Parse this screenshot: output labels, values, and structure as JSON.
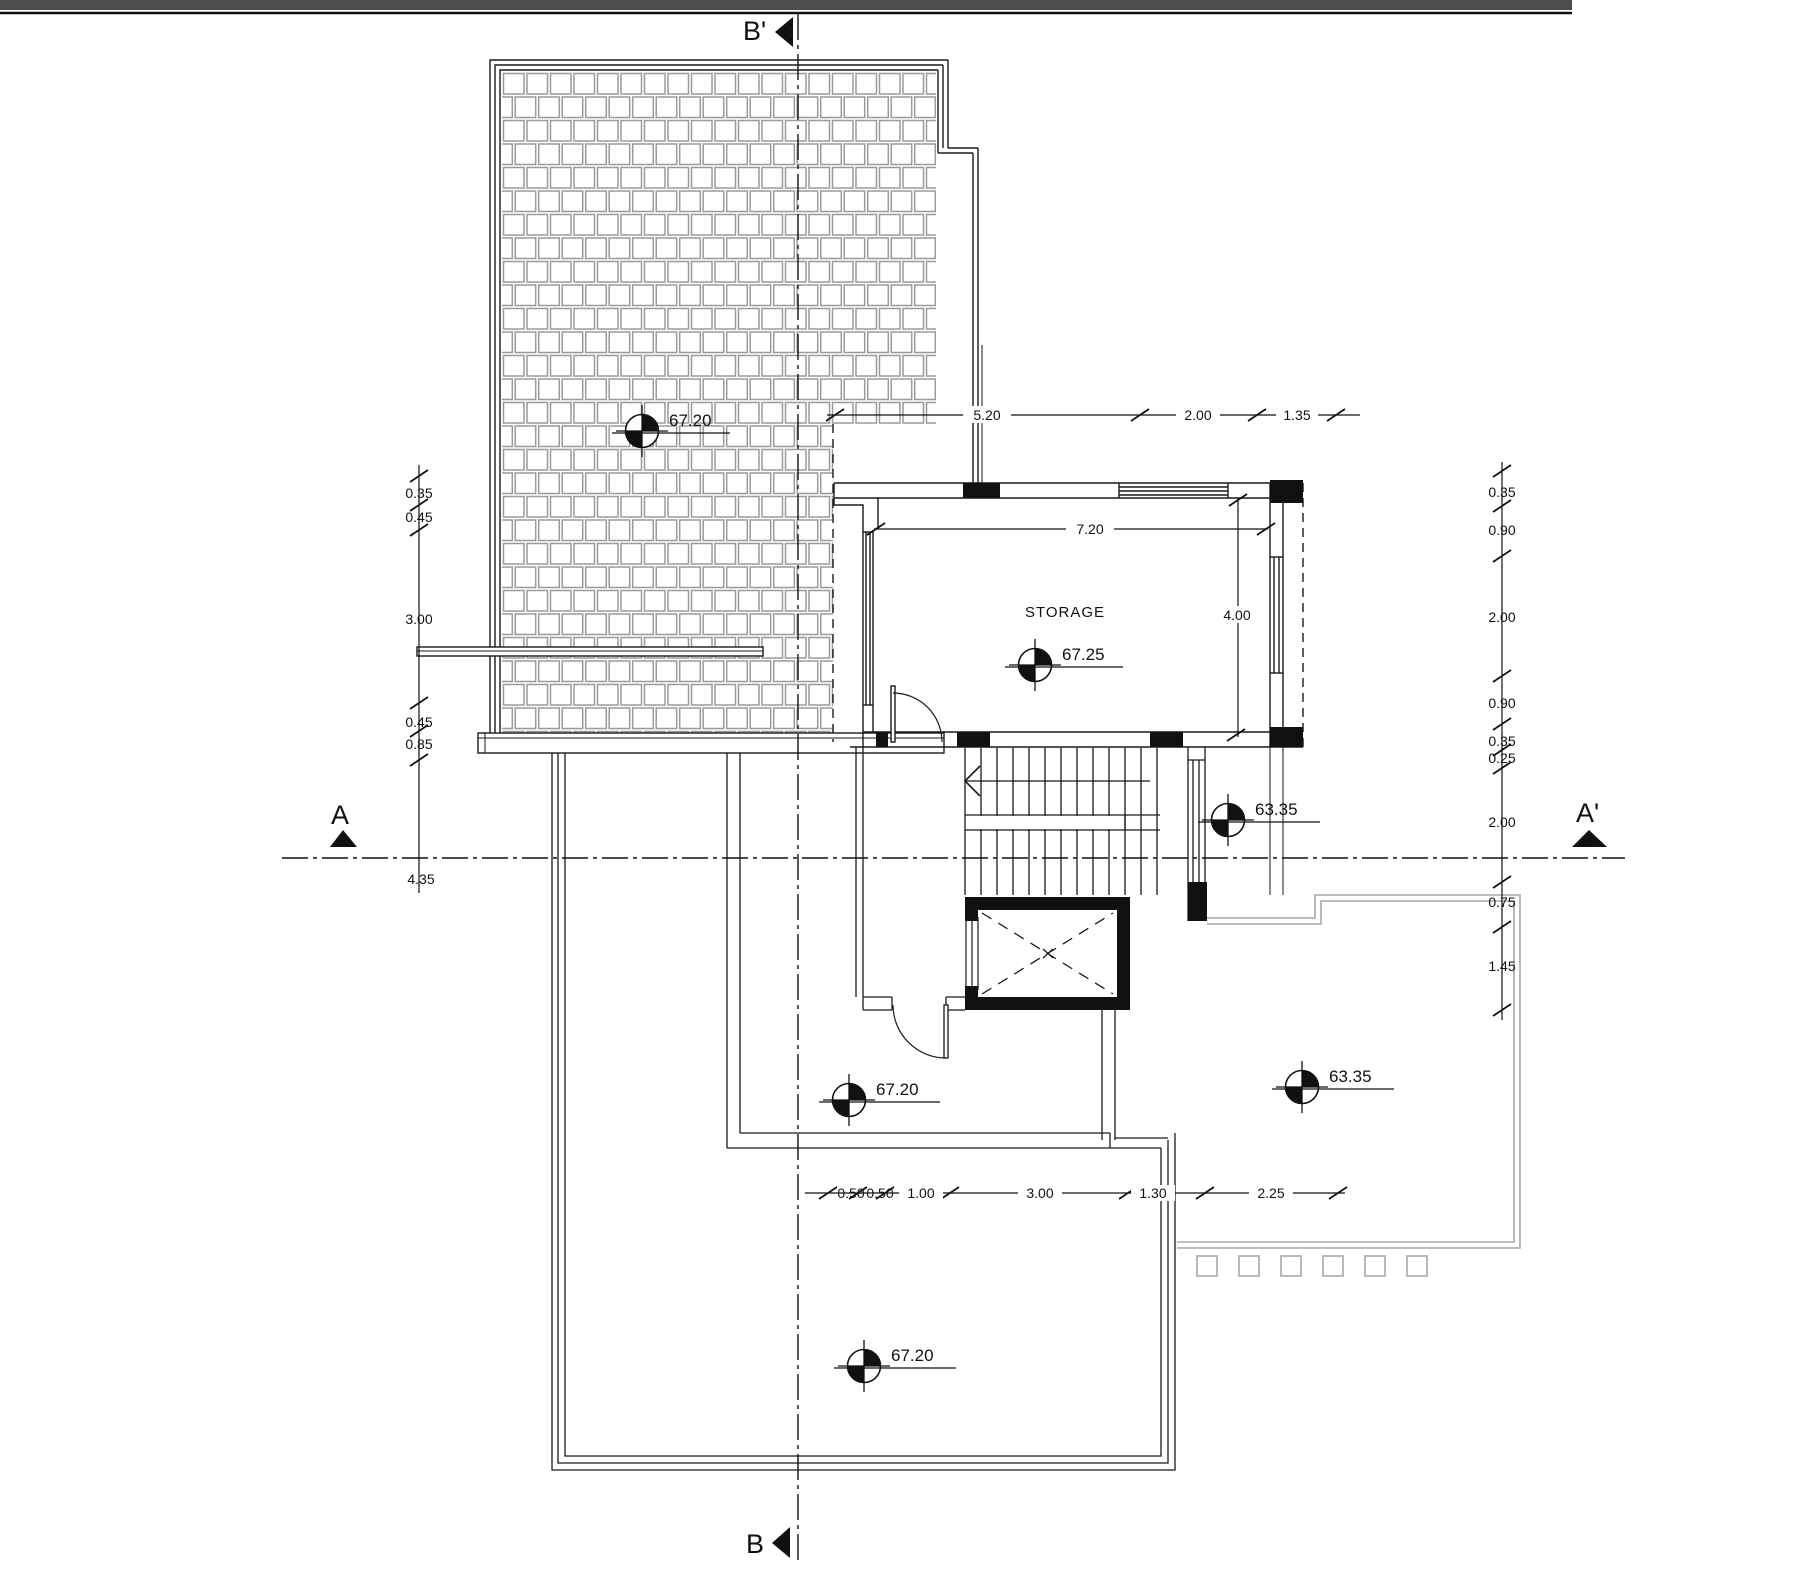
{
  "drawing_type": "architectural-roof-plan",
  "sections": {
    "b_prime": "B'",
    "b": "B",
    "a": "A",
    "a_prime": "A'"
  },
  "rooms": {
    "storage": "STORAGE"
  },
  "levels": {
    "roof": "67.20",
    "storage": "67.25",
    "stair_landing": "63.35",
    "mid_terrace": "67.20",
    "balcony": "63.35",
    "lower_terrace": "67.20"
  },
  "dims": {
    "top": [
      "5.20",
      "2.00",
      "1.35"
    ],
    "storage_width": "7.20",
    "storage_depth": "4.00",
    "left": [
      "0.35",
      "0.45",
      "3.00",
      "0.45",
      "0.85"
    ],
    "left_below_section": "4.35",
    "right": [
      "0.35",
      "0.90",
      "2.00",
      "0.90",
      "0.35",
      "0.25",
      "2.00",
      "0.75",
      "1.45"
    ],
    "bottom": [
      "0.50",
      "0.50",
      "1.00",
      "3.00",
      "1.30",
      "2.25"
    ]
  },
  "colors": {
    "line": "#1a1a1a",
    "tile_hatch": "#9a9a9a",
    "terrace_outline": "#a9a9a9",
    "top_bar": "#4d4d4d"
  }
}
